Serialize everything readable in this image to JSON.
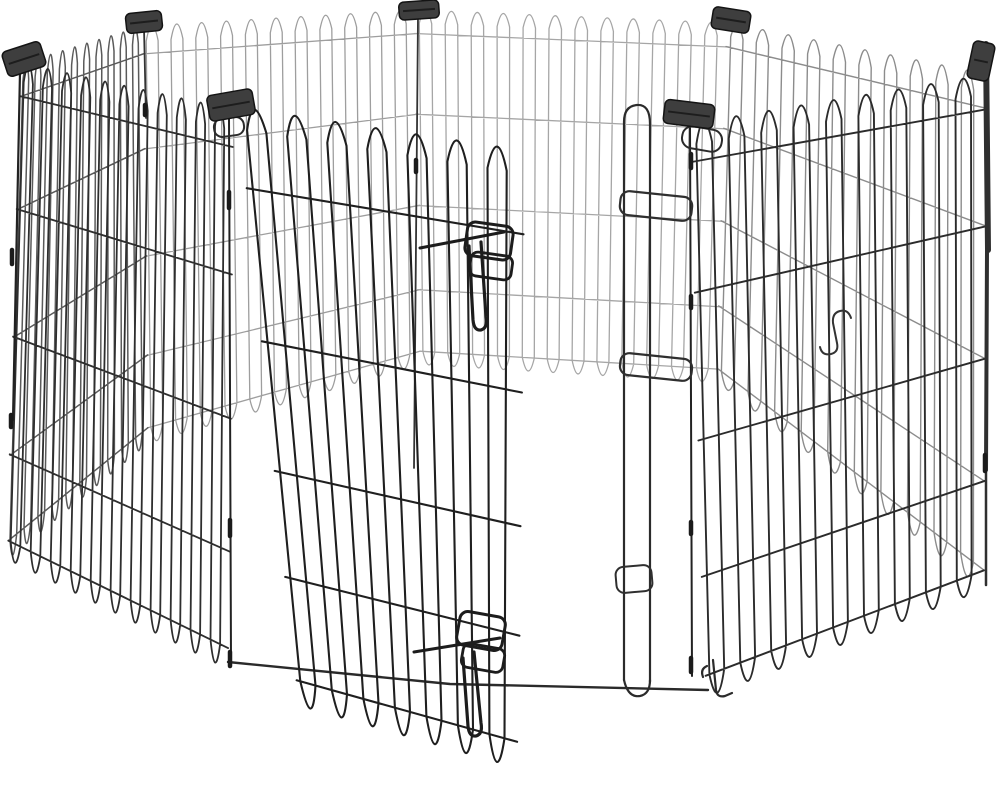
{
  "scene": {
    "width": 1000,
    "height": 785,
    "background": "#ffffff",
    "colors": {
      "wire_front": "#2b2b2b",
      "wire_door": "#1f1f1f",
      "wire_back": "#9e9e9e",
      "clip_fill": "#3e3e3e",
      "clip_stroke": "#141414",
      "hardware": "#222222"
    },
    "defaults": {
      "hfr": [
        0.07,
        0.3,
        0.56,
        0.8
      ],
      "dip": 1.05,
      "arc": -0.035
    },
    "panels": [
      {
        "name": "back-left",
        "layer": 0,
        "top": [
          143,
          25,
          416,
          9
        ],
        "bottom": [
          148,
          438,
          420,
          360
        ],
        "loops": 11,
        "color": "#9e9e9e",
        "sw": 1.3
      },
      {
        "name": "back",
        "layer": 0,
        "top": [
          416,
          9,
          728,
          22
        ],
        "bottom": [
          420,
          360,
          718,
          378
        ],
        "loops": 12,
        "color": "#a6a6a6",
        "sw": 1.3
      },
      {
        "name": "back-right",
        "layer": 0,
        "top": [
          728,
          22,
          984,
          72
        ],
        "bottom": [
          718,
          378,
          984,
          583
        ],
        "loops": 10,
        "color": "#8c8c8c",
        "sw": 1.4
      },
      {
        "name": "left",
        "layer": 0,
        "top": [
          22,
          62,
          143,
          25
        ],
        "bottom": [
          8,
          553,
          148,
          438
        ],
        "loops": 10,
        "color": "#5a5a5a",
        "sw": 1.5
      },
      {
        "name": "front-left",
        "layer": 0,
        "top": [
          22,
          62,
          232,
          108
        ],
        "bottom": [
          8,
          553,
          228,
          662
        ],
        "loops": 11,
        "color": "#2e2e2e",
        "sw": 1.8
      },
      {
        "name": "front-right",
        "layer": 0,
        "top": [
          692,
          122,
          984,
          74
        ],
        "bottom": [
          706,
          690,
          984,
          583
        ],
        "loops": 9,
        "color": "#2b2b2b",
        "sw": 1.9
      },
      {
        "name": "door",
        "layer": 1,
        "top": [
          240,
          106,
          523,
          149
        ],
        "bottom": [
          298,
          695,
          517,
          757
        ],
        "loops": 7,
        "color": "#1f1f1f",
        "sw": 2.1,
        "hfr": [
          0.14,
          0.4,
          0.62,
          0.8
        ],
        "dip": 1.06
      }
    ],
    "paths": [
      {
        "name": "front-bottom-rail",
        "layer": 0,
        "d": "M228 662 L450 684 L708 690",
        "sw": 2.4,
        "color": "#2a2a2a"
      },
      {
        "name": "door-frame-loop",
        "layer": 0,
        "d": "M624 680 L624 122 Q624 106 637 105 Q650 104 650 124 L650 682",
        "sw": 2.2,
        "color": "#2b2b2b"
      },
      {
        "name": "door-frame-foot",
        "layer": 0,
        "d": "M624 680 Q628 698 640 696 Q650 694 650 680",
        "sw": 2.2,
        "color": "#2b2b2b"
      },
      {
        "name": "corner-rod-right",
        "layer": 0,
        "d": "M690 128 L692 676",
        "sw": 2,
        "color": "#222222"
      },
      {
        "name": "corner-rod-left",
        "layer": 0,
        "d": "M229 118 L231 662",
        "sw": 2,
        "color": "#222222"
      },
      {
        "name": "corner-rod-back",
        "layer": 0,
        "d": "M418 16 L414 468",
        "sw": 1.8,
        "color": "#333333"
      },
      {
        "name": "corner-rod-backleft",
        "layer": 0,
        "d": "M144 28 L146 118",
        "sw": 1.8,
        "color": "#333333"
      },
      {
        "name": "corner-rod-leftedge",
        "layer": 0,
        "d": "M20 72 L13 420",
        "sw": 2.2,
        "color": "#222222"
      },
      {
        "name": "right-corner-bar-a",
        "layer": 0,
        "d": "M986 44 L988 250",
        "sw": 6,
        "color": "#2f2f2f"
      },
      {
        "name": "right-corner-bar-b",
        "layer": 0,
        "d": "M987 250 L986 470",
        "sw": 4,
        "color": "#2f2f2f"
      },
      {
        "name": "right-corner-bar-c",
        "layer": 0,
        "d": "M986 470 L986 585",
        "sw": 2.5,
        "color": "#2f2f2f"
      },
      {
        "name": "s-hook",
        "layer": 1,
        "d": "M851 318 q -3 -9 -11 -7 q -8 2 -7 12 l 4 20 q 2 9 -6 11 q -9 2 -11 -7",
        "sw": 2,
        "color": "#333333"
      },
      {
        "name": "bottom-right-hook-a",
        "layer": 1,
        "d": "M713 660 L716 690 q 1 8 9 6 l 7 -3",
        "sw": 2.2,
        "color": "#2b2b2b"
      },
      {
        "name": "bottom-right-hook-b",
        "layer": 1,
        "d": "M707 666 q -7 3 -4 11",
        "sw": 2.2,
        "color": "#2b2b2b"
      },
      {
        "name": "top-latch-bar",
        "layer": 1,
        "d": "M420 248 L504 232",
        "sw": 3,
        "color": "#1c1c1c"
      },
      {
        "name": "top-latch-pin",
        "layer": 1,
        "d": "M469 246 L473 320 q 1 11 8 10 q 7 -2 5 -13 L481 242",
        "sw": 3.2,
        "color": "#1c1c1c"
      },
      {
        "name": "bottom-latch-bar",
        "layer": 1,
        "d": "M414 652 L500 638",
        "sw": 3,
        "color": "#1c1c1c"
      },
      {
        "name": "bottom-latch-pin",
        "layer": 1,
        "d": "M463 658 L468 726 q 1 11 8 10 q 7 -2 5 -13 L474 652",
        "sw": 3.2,
        "color": "#1c1c1c"
      }
    ],
    "wire_rects": [
      {
        "name": "top-latch-loop-outer",
        "x": 466,
        "y": 224,
        "w": 46,
        "h": 34,
        "rx": 8,
        "rot": 8,
        "sw": 3,
        "color": "#1c1c1c"
      },
      {
        "name": "top-latch-loop-inner",
        "x": 470,
        "y": 254,
        "w": 42,
        "h": 24,
        "rx": 7,
        "rot": 8,
        "sw": 2.8,
        "color": "#1c1c1c"
      },
      {
        "name": "bottom-latch-loop-outer",
        "x": 458,
        "y": 614,
        "w": 46,
        "h": 34,
        "rx": 8,
        "rot": 10,
        "sw": 3,
        "color": "#1c1c1c"
      },
      {
        "name": "bottom-latch-loop-inner",
        "x": 462,
        "y": 646,
        "w": 42,
        "h": 24,
        "rx": 7,
        "rot": 10,
        "sw": 2.8,
        "color": "#1c1c1c"
      },
      {
        "name": "latch-catch-bracket-upper",
        "x": 620,
        "y": 194,
        "w": 72,
        "h": 24,
        "rx": 9,
        "rot": 6,
        "sw": 2.2,
        "color": "#2f2f2f"
      },
      {
        "name": "latch-catch-bracket-mid",
        "x": 620,
        "y": 356,
        "w": 72,
        "h": 22,
        "rx": 9,
        "rot": 6,
        "sw": 2.2,
        "color": "#2f2f2f"
      },
      {
        "name": "latch-catch-bracket-lower",
        "x": 616,
        "y": 566,
        "w": 36,
        "h": 26,
        "rx": 8,
        "rot": -5,
        "sw": 2,
        "color": "#2f2f2f"
      },
      {
        "name": "hinge-loop-right",
        "x": 682,
        "y": 128,
        "w": 40,
        "h": 22,
        "rx": 10,
        "rot": 10,
        "sw": 2,
        "color": "#2b2b2b"
      },
      {
        "name": "hinge-loop-left",
        "x": 214,
        "y": 118,
        "w": 30,
        "h": 18,
        "rx": 8,
        "rot": -8,
        "sw": 2,
        "color": "#2b2b2b"
      }
    ],
    "beads": [
      {
        "x": 229,
        "y": 192,
        "l": 16
      },
      {
        "x": 230,
        "y": 520,
        "l": 16
      },
      {
        "x": 230,
        "y": 652,
        "l": 14
      },
      {
        "x": 691,
        "y": 154,
        "l": 14
      },
      {
        "x": 691,
        "y": 296,
        "l": 12
      },
      {
        "x": 691,
        "y": 522,
        "l": 12
      },
      {
        "x": 691,
        "y": 658,
        "l": 14
      },
      {
        "x": 416,
        "y": 160,
        "l": 12
      },
      {
        "x": 12,
        "y": 250,
        "l": 14
      },
      {
        "x": 11,
        "y": 415,
        "l": 12
      },
      {
        "x": 145,
        "y": 105,
        "l": 10
      },
      {
        "x": 985,
        "y": 455,
        "l": 16
      }
    ],
    "clips": [
      {
        "name": "corner-clip-left",
        "x": 4,
        "y": 46,
        "w": 40,
        "h": 26,
        "rot": -18
      },
      {
        "name": "corner-clip-back-left",
        "x": 126,
        "y": 12,
        "w": 36,
        "h": 20,
        "rot": -6
      },
      {
        "name": "corner-clip-back",
        "x": 399,
        "y": 1,
        "w": 40,
        "h": 18,
        "rot": -4
      },
      {
        "name": "corner-clip-back-right",
        "x": 712,
        "y": 9,
        "w": 38,
        "h": 22,
        "rot": 9
      },
      {
        "name": "corner-clip-right",
        "x": 970,
        "y": 42,
        "w": 22,
        "h": 38,
        "rot": 12
      },
      {
        "name": "corner-clip-front-right",
        "x": 664,
        "y": 102,
        "w": 50,
        "h": 24,
        "rot": 7
      },
      {
        "name": "corner-clip-front-left",
        "x": 208,
        "y": 92,
        "w": 46,
        "h": 26,
        "rot": -10
      }
    ]
  }
}
